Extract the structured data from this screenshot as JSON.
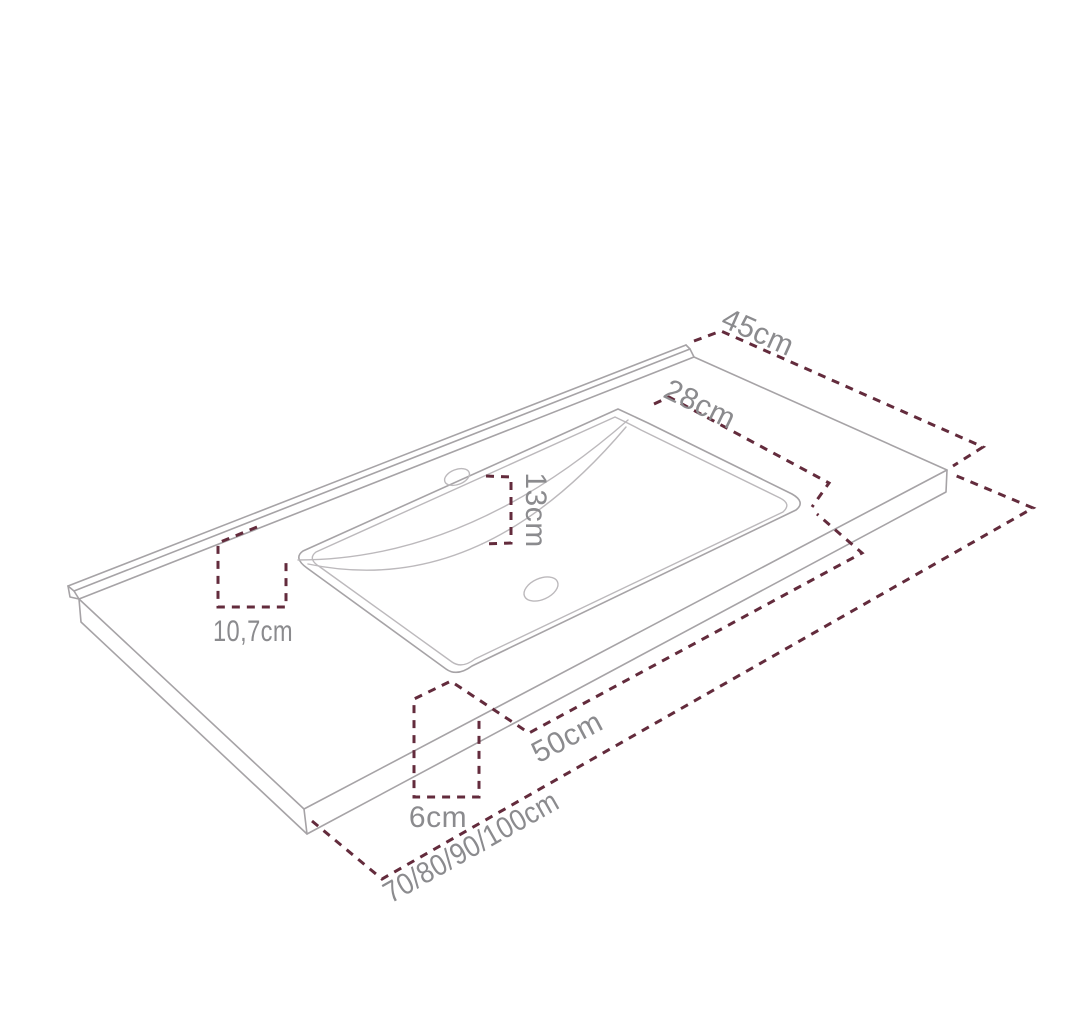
{
  "diagram": {
    "type": "technical-dimension-drawing",
    "subject": "vanity washbasin countertop, isometric view",
    "labels": {
      "overall_depth": "45cm",
      "basin_depth": "28cm",
      "bowl_back_offset": "13cm",
      "side_offset": "10,7cm",
      "basin_width": "50cm",
      "front_offset": "6cm",
      "available_widths": "70/80/90/100cm"
    },
    "colors": {
      "dimension_line": "#632b3c",
      "outline": "#a6a3a6",
      "label_text": "#8b8b8e",
      "background": "#ffffff"
    }
  }
}
